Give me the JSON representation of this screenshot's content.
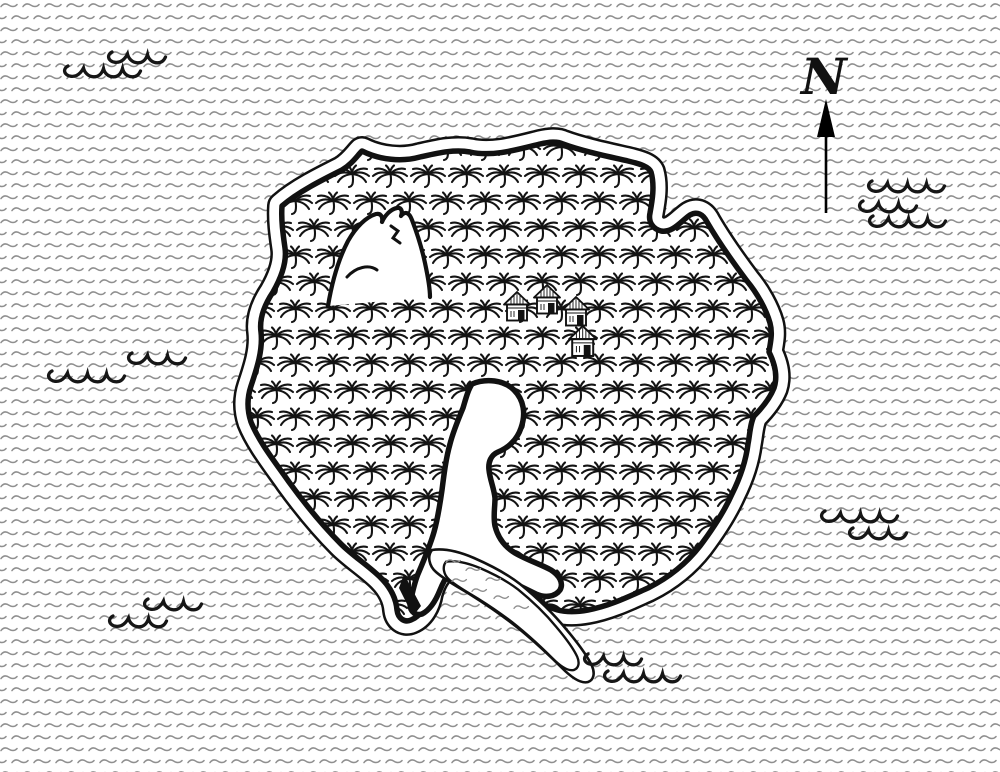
{
  "document": {
    "kind": "hand-drawn island map",
    "background": "#ffffff"
  },
  "palette": {
    "ink": "#111111",
    "sea_ripple_gray": "#8f8f8f",
    "paper": "#ffffff"
  },
  "compass": {
    "label": "N"
  },
  "features": {
    "island": {
      "cover": "palm forest",
      "hut_count": 4,
      "has_mountain": true,
      "has_lagoon": true,
      "has_inlet": true
    },
    "huts": [
      {
        "x": 503,
        "y": 291,
        "s": 1
      },
      {
        "x": 533,
        "y": 284,
        "s": 1
      },
      {
        "x": 562,
        "y": 296,
        "s": 1
      },
      {
        "x": 568,
        "y": 325,
        "s": 1.05
      }
    ],
    "wave_rows": [
      {
        "cluster": 1,
        "x": 107,
        "y": 50,
        "arcs": 3
      },
      {
        "cluster": 1,
        "x": 63,
        "y": 64,
        "arcs": 4
      },
      {
        "cluster": 2,
        "x": 127,
        "y": 351,
        "arcs": 3
      },
      {
        "cluster": 2,
        "x": 47,
        "y": 369,
        "arcs": 4
      },
      {
        "cluster": 3,
        "x": 143,
        "y": 597,
        "arcs": 3
      },
      {
        "cluster": 3,
        "x": 108,
        "y": 614,
        "arcs": 3
      },
      {
        "cluster": 4,
        "x": 867,
        "y": 179,
        "arcs": 4
      },
      {
        "cluster": 4,
        "x": 858,
        "y": 199,
        "arcs": 3
      },
      {
        "cluster": 4,
        "x": 868,
        "y": 214,
        "arcs": 4
      },
      {
        "cluster": 5,
        "x": 820,
        "y": 509,
        "arcs": 4
      },
      {
        "cluster": 5,
        "x": 848,
        "y": 526,
        "arcs": 3
      },
      {
        "cluster": 6,
        "x": 583,
        "y": 652,
        "arcs": 3
      },
      {
        "cluster": 6,
        "x": 603,
        "y": 669,
        "arcs": 4
      }
    ],
    "inlet_ripples": [
      {
        "x": 446,
        "y": 560
      },
      {
        "x": 466,
        "y": 568
      },
      {
        "x": 486,
        "y": 578
      },
      {
        "x": 452,
        "y": 579
      },
      {
        "x": 472,
        "y": 589
      },
      {
        "x": 494,
        "y": 596
      },
      {
        "x": 514,
        "y": 606
      }
    ]
  }
}
